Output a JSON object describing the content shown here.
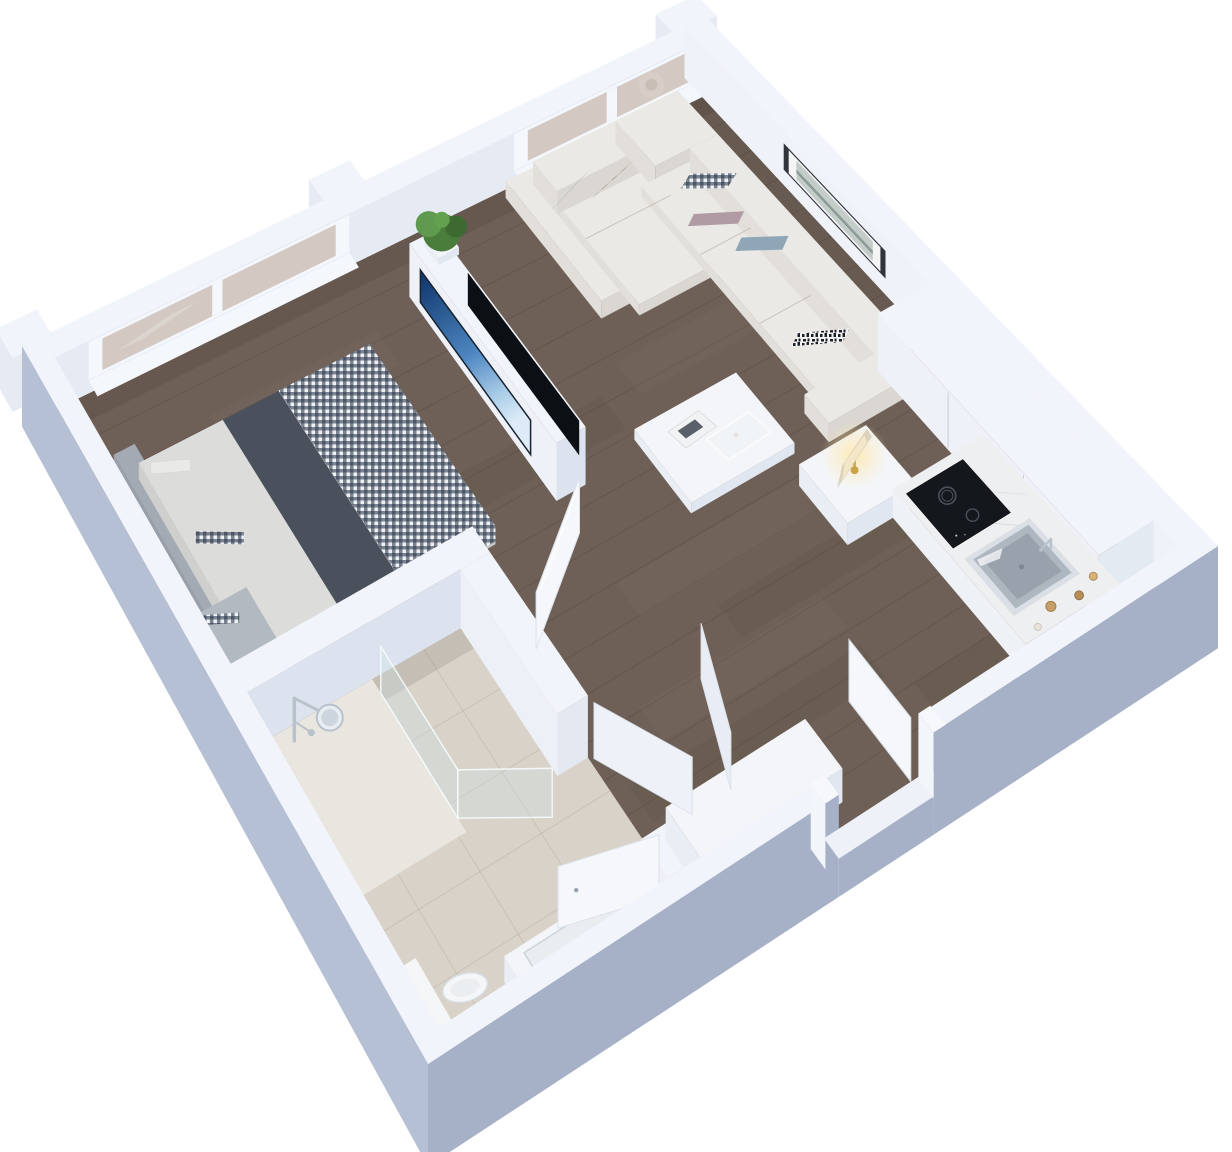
{
  "meta": {
    "title": "3D isometric floor plan render - studio apartment with bedroom, living room, kitchenette, bathroom and entry hall",
    "view": "axonometric cutaway dollhouse view, no visible text in image"
  },
  "colors": {
    "bg": "#ffffff",
    "wallTop": "#f1f4fa",
    "wallInnerNW": "#e6eaf3",
    "wallInnerNE": "#eff2f8",
    "wallOuterSW": "#b6c0d4",
    "wallOuterSE": "#a6b1c7",
    "wallShade": "#dde3ee",
    "partitionSide": "#eef1f7",
    "floorWood": "#6e6057",
    "plankDark": "#594c42",
    "plankLight": "#827266",
    "floorTile": "#d8d2c9",
    "tileLine": "#bdb4a7",
    "showerTray": "#e9e6e0",
    "glassBeige": "#d3c8c2",
    "windowFrame": "#f4f7fc",
    "wreath": "#d7cdc6",
    "frameDark": "#30353c",
    "artMat": "#f3f4f3",
    "artImage": "#c3ccc8",
    "artLine": "#75867e",
    "tvDark": "#0c1014",
    "tvBlueTop": "#0d3268",
    "tvBlueMid": "#4d86c0",
    "tvBlueLight": "#dcebf7",
    "plant": "#4a7c3c",
    "plantLight": "#5f9a4e",
    "plantMid": "#63a050",
    "plantDark": "#3c6a31",
    "headboard": "#a3aab4",
    "headboardSide": "#99a0aa",
    "headboardFront": "#8f96a1",
    "bedSheet": "#dcdddb",
    "bedSheetSide": "#c6c8c8",
    "runner": "#4b515c",
    "runnerSide": "#404653",
    "benchTop": "#b3b9c1",
    "benchSide": "#a5abb4",
    "benchFront": "#9aa1aa",
    "gingBg": "#eef0f4",
    "gingDark": "#2f3a4c",
    "sofaTop": "#ebe9e5",
    "sofaFront": "#dad6d1",
    "sofaSide": "#e2dfda",
    "pillowGray": "#9aa4ad",
    "pillowMauve": "#b09aa3",
    "pillowBlue": "#8ea6b6",
    "stripeBg": "#f2f3f5",
    "stripeInk": "#1c1f24",
    "moscA": "#8c7f6a",
    "moscB": "#5e5446",
    "moscC": "#b5aa93",
    "moscD": "#cdbfa9",
    "boxTop": "#f3f5f9",
    "boxLeft": "#e9edf4",
    "boxFront": "#e1e7f0",
    "marble": "#edeff1",
    "marbleVein": "#c9ced4",
    "cooktop": "#14171b",
    "ring": "#4a5158",
    "steel": "#aeb6bf",
    "steelDark": "#99a2ac",
    "steelLight": "#d9dfe5",
    "chrome": "#b9c2cb",
    "woodJar1": "#c79f66",
    "woodJar2": "#b78e57",
    "woodJar3": "#d8b37b",
    "jarWhite": "#e7e3da",
    "toilet": "#f4f6f8",
    "toiletShade": "#dfe4e9",
    "glassFill": "rgba(205,228,230,0.32)",
    "glassEdge": "rgba(245,252,252,0.9)",
    "door": "#f5f7fa",
    "doorEdge": "#dde3ec",
    "lampShade": "#ddd2bd",
    "lampShadeLit": "#f6e9c9",
    "lampGold": "#c9a24a",
    "glow": "#ffe9ad",
    "applianceDark": "#272c33",
    "baseShadow": "rgba(60,50,40,0.16)"
  },
  "rooms": [
    {
      "id": "bedroom",
      "label": "Bedroom",
      "floor": "dark wood",
      "position": "top-left"
    },
    {
      "id": "living-room",
      "label": "Living room",
      "floor": "dark wood",
      "position": "top-right"
    },
    {
      "id": "kitchenette",
      "label": "Kitchenette",
      "floor": "dark wood",
      "position": "right"
    },
    {
      "id": "bathroom",
      "label": "Bathroom",
      "floor": "beige tile",
      "position": "bottom-left"
    },
    {
      "id": "entry-hall",
      "label": "Entry hall",
      "floor": "dark wood",
      "position": "bottom-center"
    }
  ],
  "scene_items": [
    {
      "id": "floor-wood",
      "label": "Dark wood flooring"
    },
    {
      "id": "floor-tile",
      "label": "Bathroom tile floor"
    },
    {
      "id": "shower-tray",
      "label": "Shower tray"
    },
    {
      "id": "wall-piers",
      "label": "Exterior wall piers"
    },
    {
      "id": "wall-nw",
      "label": "North-west exterior wall"
    },
    {
      "id": "window-bedroom",
      "label": "Bedroom window (2 panes)"
    },
    {
      "id": "window-living",
      "label": "Living room window (2 panes, wreath)"
    },
    {
      "id": "wall-ne",
      "label": "North-east exterior wall"
    },
    {
      "id": "wall-art",
      "label": "Framed wall art"
    },
    {
      "id": "tv-partition",
      "label": "Freestanding TV partition wall"
    },
    {
      "id": "tv-bedroom",
      "label": "Bedroom TV showing blue image"
    },
    {
      "id": "tv-living",
      "label": "Living room TV switched off"
    },
    {
      "id": "plant",
      "label": "Potted green plant"
    },
    {
      "id": "bed",
      "label": "Double bed with gingham duvet"
    },
    {
      "id": "bench",
      "label": "Gray bedroom bench"
    },
    {
      "id": "wall-bedroom-south",
      "label": "Bedroom-bathroom partition wall"
    },
    {
      "id": "wall-bathroom-east",
      "label": "Bathroom wall with doorway"
    },
    {
      "id": "shower",
      "label": "Chrome shower set"
    },
    {
      "id": "shower-glass",
      "label": "Glass shower screen"
    },
    {
      "id": "toilet",
      "label": "Toilet"
    },
    {
      "id": "vanity",
      "label": "Vanity basin"
    },
    {
      "id": "door-bathroom",
      "label": "Bathroom door (open)"
    },
    {
      "id": "door-bedroom",
      "label": "Bedroom door (open)"
    },
    {
      "id": "sofa",
      "label": "White L-shaped sectional sofa"
    },
    {
      "id": "pillows",
      "label": "Throw pillows (6)"
    },
    {
      "id": "coffee-table",
      "label": "White coffee table with magazine and tray"
    },
    {
      "id": "side-table",
      "label": "White side table"
    },
    {
      "id": "lamp",
      "label": "Table lamp (lit)"
    },
    {
      "id": "kitchen-cabinets",
      "label": "Tall white kitchen cabinets"
    },
    {
      "id": "kitchen-counter",
      "label": "Marble kitchen counter"
    },
    {
      "id": "cooktop",
      "label": "Black induction cooktop (2 burners)"
    },
    {
      "id": "sink",
      "label": "Stainless steel sink with faucet"
    },
    {
      "id": "canisters",
      "label": "Wooden canisters (3) and white jar"
    },
    {
      "id": "sideboard",
      "label": "White entry sideboard"
    },
    {
      "id": "closet-doors",
      "label": "Open closet doors"
    },
    {
      "id": "wall-se-entry",
      "label": "South-east wall with entry doorway"
    },
    {
      "id": "door-entry",
      "label": "Entry door (open)"
    },
    {
      "id": "wall-sw",
      "label": "South-west exterior wall"
    }
  ]
}
